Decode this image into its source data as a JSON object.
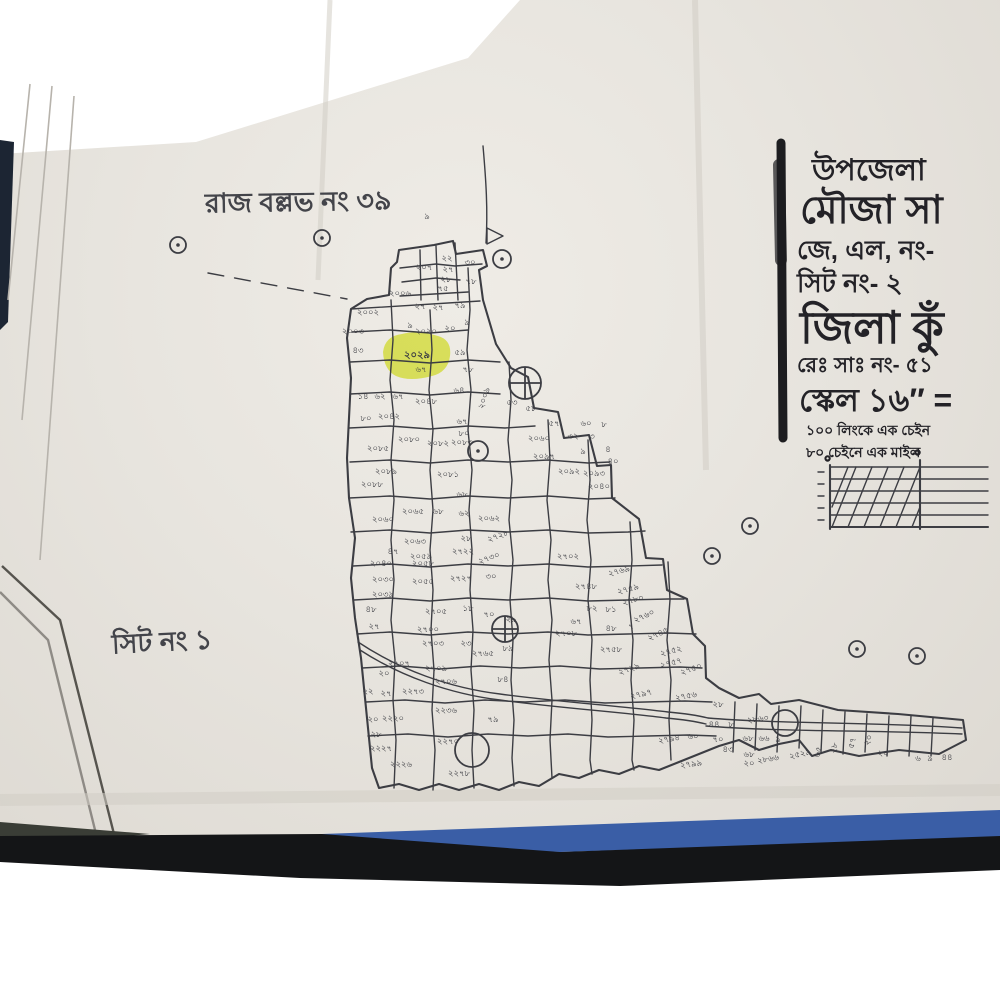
{
  "colors": {
    "paper": "#e8e5df",
    "ink": "#3c3d43",
    "print_ink": "#232227",
    "highlight": "#e3ee3e",
    "tape_blue": "#3a5ea6",
    "floor_black": "#141517"
  },
  "map": {
    "area_label": "রাজ বল্লভ নং ৩৯",
    "sheet_label": "সিট নং ১",
    "highlight_plot": {
      "number": "২০২৯",
      "note": "৬৭"
    },
    "plot_labels": [
      {
        "x": 447,
        "y": 258,
        "t": "২২"
      },
      {
        "x": 470,
        "y": 262,
        "t": "৩০"
      },
      {
        "x": 424,
        "y": 267,
        "t": "২০৭"
      },
      {
        "x": 448,
        "y": 269,
        "t": "২৭"
      },
      {
        "x": 446,
        "y": 279,
        "t": "২৮"
      },
      {
        "x": 471,
        "y": 281,
        "t": "৭৮"
      },
      {
        "x": 443,
        "y": 288,
        "t": "৭৫"
      },
      {
        "x": 400,
        "y": 293,
        "t": "২০০৬"
      },
      {
        "x": 420,
        "y": 306,
        "t": "২৭"
      },
      {
        "x": 438,
        "y": 307,
        "t": "২৭"
      },
      {
        "x": 460,
        "y": 305,
        "t": "৭৯"
      },
      {
        "x": 368,
        "y": 312,
        "t": "২০০২"
      },
      {
        "x": 410,
        "y": 325,
        "t": "৯"
      },
      {
        "x": 426,
        "y": 331,
        "t": "২০২০"
      },
      {
        "x": 450,
        "y": 328,
        "t": "২০"
      },
      {
        "x": 467,
        "y": 322,
        "t": "৯"
      },
      {
        "x": 353,
        "y": 331,
        "t": "২০০৩"
      },
      {
        "x": 358,
        "y": 350,
        "t": "৪৩"
      },
      {
        "x": 427,
        "y": 216,
        "t": "৯"
      },
      {
        "x": 460,
        "y": 352,
        "t": "৫৯"
      },
      {
        "x": 468,
        "y": 369,
        "t": "৭৮"
      },
      {
        "x": 363,
        "y": 396,
        "t": "১৪"
      },
      {
        "x": 380,
        "y": 396,
        "t": "৬২"
      },
      {
        "x": 398,
        "y": 396,
        "t": "৬৭"
      },
      {
        "x": 426,
        "y": 401,
        "t": "২০৪৮"
      },
      {
        "x": 459,
        "y": 390,
        "t": "৬৪"
      },
      {
        "x": 484,
        "y": 398,
        "t": "২০০৯",
        "r": -72
      },
      {
        "x": 366,
        "y": 418,
        "t": "৮০"
      },
      {
        "x": 389,
        "y": 416,
        "t": "২০৪২"
      },
      {
        "x": 462,
        "y": 421,
        "t": "৬৭"
      },
      {
        "x": 464,
        "y": 433,
        "t": "৮০"
      },
      {
        "x": 409,
        "y": 439,
        "t": "২০৮০"
      },
      {
        "x": 438,
        "y": 443,
        "t": "২০৮২"
      },
      {
        "x": 462,
        "y": 442,
        "t": "২০৮৩"
      },
      {
        "x": 378,
        "y": 448,
        "t": "২০৮৫"
      },
      {
        "x": 386,
        "y": 471,
        "t": "২০৮৯"
      },
      {
        "x": 448,
        "y": 474,
        "t": "২০৮১"
      },
      {
        "x": 372,
        "y": 484,
        "t": "২০৮৮"
      },
      {
        "x": 512,
        "y": 402,
        "t": "৫৩"
      },
      {
        "x": 531,
        "y": 408,
        "t": "৫৮"
      },
      {
        "x": 554,
        "y": 423,
        "t": "৫৭"
      },
      {
        "x": 586,
        "y": 423,
        "t": "৬০"
      },
      {
        "x": 539,
        "y": 438,
        "t": "২০৬০"
      },
      {
        "x": 573,
        "y": 436,
        "t": "৩২"
      },
      {
        "x": 604,
        "y": 424,
        "t": "৮"
      },
      {
        "x": 592,
        "y": 436,
        "t": "৩"
      },
      {
        "x": 583,
        "y": 451,
        "t": "৯"
      },
      {
        "x": 608,
        "y": 449,
        "t": "৪"
      },
      {
        "x": 613,
        "y": 461,
        "t": "৪০"
      },
      {
        "x": 544,
        "y": 456,
        "t": "২০৯৭"
      },
      {
        "x": 569,
        "y": 471,
        "t": "২০৯২"
      },
      {
        "x": 594,
        "y": 473,
        "t": "২০৯৩"
      },
      {
        "x": 599,
        "y": 486,
        "t": "২০৪০"
      },
      {
        "x": 462,
        "y": 494,
        "t": "৬৮"
      },
      {
        "x": 413,
        "y": 511,
        "t": "২০৬৫"
      },
      {
        "x": 438,
        "y": 511,
        "t": "৬৮"
      },
      {
        "x": 464,
        "y": 513,
        "t": "৬২"
      },
      {
        "x": 489,
        "y": 518,
        "t": "২০৬২"
      },
      {
        "x": 383,
        "y": 519,
        "t": "২০৬০"
      },
      {
        "x": 498,
        "y": 536,
        "t": "২৭২৮",
        "r": -20
      },
      {
        "x": 415,
        "y": 541,
        "t": "২০৬৩"
      },
      {
        "x": 466,
        "y": 538,
        "t": "২৮"
      },
      {
        "x": 393,
        "y": 551,
        "t": "৪৭"
      },
      {
        "x": 421,
        "y": 556,
        "t": "২০৫৯"
      },
      {
        "x": 463,
        "y": 551,
        "t": "২৭২২"
      },
      {
        "x": 489,
        "y": 558,
        "t": "২৭৩০",
        "r": -20
      },
      {
        "x": 381,
        "y": 563,
        "t": "২০৪০"
      },
      {
        "x": 423,
        "y": 563,
        "t": "২০৫৮"
      },
      {
        "x": 383,
        "y": 579,
        "t": "২০৩০"
      },
      {
        "x": 423,
        "y": 581,
        "t": "২০৫৫"
      },
      {
        "x": 461,
        "y": 578,
        "t": "২৭২৭"
      },
      {
        "x": 491,
        "y": 576,
        "t": "৩০"
      },
      {
        "x": 383,
        "y": 594,
        "t": "২০৩৯"
      },
      {
        "x": 371,
        "y": 609,
        "t": "৪৮"
      },
      {
        "x": 436,
        "y": 611,
        "t": "২৭০৫"
      },
      {
        "x": 468,
        "y": 608,
        "t": "১৮"
      },
      {
        "x": 489,
        "y": 614,
        "t": "৭০"
      },
      {
        "x": 511,
        "y": 619,
        "t": "২৯"
      },
      {
        "x": 374,
        "y": 626,
        "t": "২৭"
      },
      {
        "x": 428,
        "y": 629,
        "t": "২৭০০"
      },
      {
        "x": 433,
        "y": 643,
        "t": "২৭০৩"
      },
      {
        "x": 466,
        "y": 643,
        "t": "২৩"
      },
      {
        "x": 508,
        "y": 648,
        "t": "৮৯"
      },
      {
        "x": 483,
        "y": 653,
        "t": "২৭৬৫"
      },
      {
        "x": 399,
        "y": 663,
        "t": "২৭০৭"
      },
      {
        "x": 436,
        "y": 668,
        "t": "২৭০৯"
      },
      {
        "x": 384,
        "y": 673,
        "t": "২০"
      },
      {
        "x": 503,
        "y": 679,
        "t": "৮৪"
      },
      {
        "x": 446,
        "y": 681,
        "t": "২৭০৬"
      },
      {
        "x": 368,
        "y": 691,
        "t": "২২"
      },
      {
        "x": 386,
        "y": 693,
        "t": "২৭"
      },
      {
        "x": 413,
        "y": 691,
        "t": "২২৭৩"
      },
      {
        "x": 446,
        "y": 710,
        "t": "২২৩৬"
      },
      {
        "x": 373,
        "y": 719,
        "t": "২০"
      },
      {
        "x": 393,
        "y": 718,
        "t": "২২২০"
      },
      {
        "x": 493,
        "y": 719,
        "t": "৭৯"
      },
      {
        "x": 376,
        "y": 734,
        "t": "২৮"
      },
      {
        "x": 448,
        "y": 741,
        "t": "২২৭০"
      },
      {
        "x": 381,
        "y": 748,
        "t": "২২২৭"
      },
      {
        "x": 401,
        "y": 764,
        "t": "২২২৬"
      },
      {
        "x": 459,
        "y": 773,
        "t": "২২৭৮"
      },
      {
        "x": 568,
        "y": 556,
        "t": "২৭০২"
      },
      {
        "x": 619,
        "y": 571,
        "t": "২৭৬৯",
        "r": -15
      },
      {
        "x": 586,
        "y": 586,
        "t": "২৭৪৮"
      },
      {
        "x": 628,
        "y": 589,
        "t": "২৭৫৯",
        "r": -15
      },
      {
        "x": 633,
        "y": 600,
        "t": "২৭৮০",
        "r": -15
      },
      {
        "x": 592,
        "y": 608,
        "t": "৮২"
      },
      {
        "x": 611,
        "y": 609,
        "t": "৮১"
      },
      {
        "x": 644,
        "y": 616,
        "t": "২৭৬০",
        "r": -25
      },
      {
        "x": 576,
        "y": 621,
        "t": "৬৭"
      },
      {
        "x": 611,
        "y": 628,
        "t": "৪৮"
      },
      {
        "x": 631,
        "y": 626,
        "t": "৭"
      },
      {
        "x": 658,
        "y": 634,
        "t": "২৭৪৫",
        "r": -25
      },
      {
        "x": 566,
        "y": 633,
        "t": "২৭০৮"
      },
      {
        "x": 611,
        "y": 649,
        "t": "২৭৫৮"
      },
      {
        "x": 671,
        "y": 651,
        "t": "২৭৫২",
        "r": -15
      },
      {
        "x": 671,
        "y": 663,
        "t": "২৭৫৭",
        "r": -15
      },
      {
        "x": 629,
        "y": 669,
        "t": "২৭২৯",
        "r": -20
      },
      {
        "x": 691,
        "y": 669,
        "t": "২৭৫০",
        "r": -20
      },
      {
        "x": 641,
        "y": 694,
        "t": "২৭৯৭",
        "r": -12
      },
      {
        "x": 686,
        "y": 696,
        "t": "২৭৫৬",
        "r": -10
      },
      {
        "x": 718,
        "y": 704,
        "t": "২৮"
      },
      {
        "x": 714,
        "y": 724,
        "t": "৪৪"
      },
      {
        "x": 731,
        "y": 724,
        "t": "৮"
      },
      {
        "x": 758,
        "y": 719,
        "t": "২৮৬০",
        "r": -8
      },
      {
        "x": 669,
        "y": 739,
        "t": "২৭৯৪",
        "r": -10
      },
      {
        "x": 693,
        "y": 736,
        "t": "৬০"
      },
      {
        "x": 718,
        "y": 739,
        "t": "৭০"
      },
      {
        "x": 728,
        "y": 749,
        "t": "৪৩"
      },
      {
        "x": 748,
        "y": 738,
        "t": "৬৮"
      },
      {
        "x": 764,
        "y": 738,
        "t": "৬৬"
      },
      {
        "x": 778,
        "y": 739,
        "t": "৯"
      },
      {
        "x": 691,
        "y": 764,
        "t": "২৭৯৯",
        "r": -8
      },
      {
        "x": 749,
        "y": 754,
        "t": "৬৮"
      },
      {
        "x": 749,
        "y": 763,
        "t": "২০"
      },
      {
        "x": 768,
        "y": 759,
        "t": "২৮৬৬",
        "r": -10
      },
      {
        "x": 800,
        "y": 754,
        "t": "২৫২৯",
        "r": -14
      },
      {
        "x": 818,
        "y": 752,
        "t": "৬৫",
        "r": -75
      },
      {
        "x": 834,
        "y": 748,
        "t": "২৮",
        "r": -75
      },
      {
        "x": 852,
        "y": 743,
        "t": "৫৭",
        "r": -75
      },
      {
        "x": 868,
        "y": 740,
        "t": "২০",
        "r": -70
      },
      {
        "x": 883,
        "y": 753,
        "t": "২০"
      },
      {
        "x": 918,
        "y": 758,
        "t": "৬"
      },
      {
        "x": 930,
        "y": 758,
        "t": "৯"
      },
      {
        "x": 947,
        "y": 757,
        "t": "৪৪"
      }
    ],
    "symbols": [
      {
        "x": 178,
        "y": 245,
        "r": 8,
        "type": "dot"
      },
      {
        "x": 322,
        "y": 238,
        "r": 8,
        "type": "dot"
      },
      {
        "x": 502,
        "y": 259,
        "r": 9,
        "type": "dot"
      },
      {
        "x": 750,
        "y": 526,
        "r": 8,
        "type": "dot"
      },
      {
        "x": 712,
        "y": 556,
        "r": 8,
        "type": "dot"
      },
      {
        "x": 857,
        "y": 649,
        "r": 8,
        "type": "dot"
      },
      {
        "x": 917,
        "y": 656,
        "r": 8,
        "type": "dot"
      },
      {
        "x": 525,
        "y": 383,
        "r": 16,
        "type": "cross"
      },
      {
        "x": 478,
        "y": 451,
        "r": 10,
        "type": "dot"
      },
      {
        "x": 505,
        "y": 629,
        "r": 13,
        "type": "cross"
      },
      {
        "x": 472,
        "y": 750,
        "r": 17,
        "type": "plain"
      },
      {
        "x": 785,
        "y": 723,
        "r": 13,
        "type": "plain"
      }
    ]
  },
  "legend": {
    "upazila": "উপজেলা",
    "mouza": "মৌজা সা",
    "jl_no": "জে, এল, নং-",
    "sheet_no": "সিট নং- ২",
    "district": "জিলা কুঁ",
    "rs_no": "রেঃ সাঃ নং- ৫১",
    "scale": "স্কেল ১৬″ =",
    "scale_note1": "১০০ লিংকে এক চেইন",
    "scale_note2": "৮০ চেইনে এক মাইল",
    "scale_zero_left": "০",
    "scale_zero_mid": "০"
  }
}
